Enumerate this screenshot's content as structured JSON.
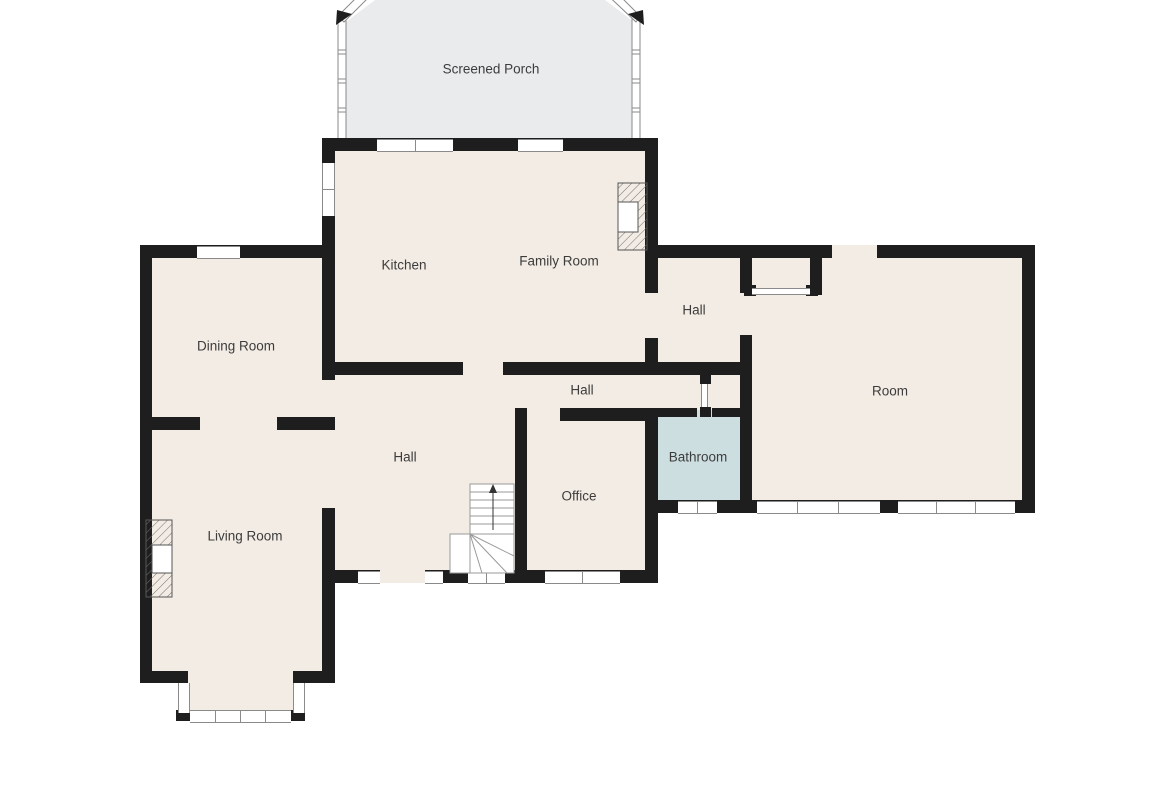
{
  "document_type": "floor-plan",
  "rooms": {
    "screened_porch": "Screened Porch",
    "kitchen": "Kitchen",
    "family_room": "Family Room",
    "hall_upper": "Hall",
    "dining_room": "Dining Room",
    "hall_corridor": "Hall",
    "room": "Room",
    "hall_center": "Hall",
    "bathroom": "Bathroom",
    "office": "Office",
    "living_room": "Living Room"
  },
  "icons": {
    "stairs_direction_arrow": "up-arrow"
  },
  "colors": {
    "wall": "#1e1e1e",
    "floor": "#f3ece4",
    "porch": "#e9ebec",
    "bathroom": "#cddee1",
    "window_line": "#8a8a8a",
    "label": "#3c3c3c",
    "stair_line": "#9a9a9a",
    "hatch": "#707070",
    "background": "#ffffff"
  }
}
